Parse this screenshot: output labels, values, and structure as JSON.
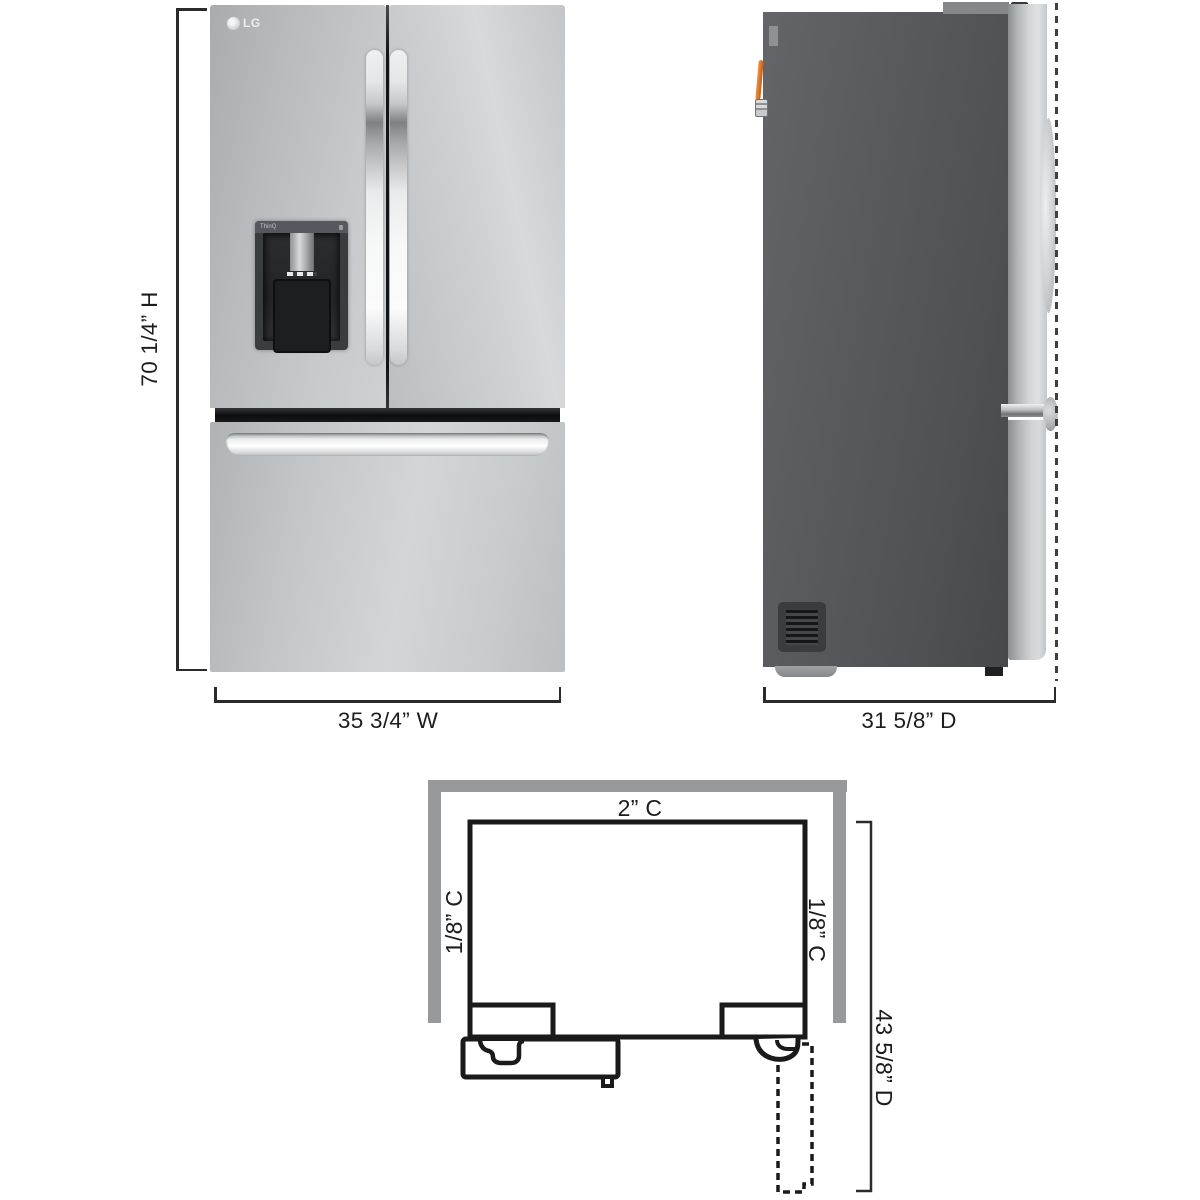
{
  "brand": {
    "logo_text": "LG",
    "dispenser_label": "ThinQ"
  },
  "front_view": {
    "height_label": "70 1/4” H",
    "width_label": "35 3/4” W"
  },
  "side_view": {
    "depth_label": "31 5/8” D"
  },
  "top_view": {
    "back_clearance_label": "2” C",
    "left_clearance_label": "1/8” C",
    "right_clearance_label": "1/8” C",
    "door_open_depth_label": "43 5/8” D"
  },
  "colors": {
    "wall_gray": "#98999b",
    "diagram_line": "#1a1a1a",
    "stainless_steel": "#c9cccd",
    "back_panel_gray": "#54565a",
    "dispenser_dark": "#33363a",
    "water_valve_orange": "#dd7c33",
    "dimension_line": "#2b2b2b"
  }
}
